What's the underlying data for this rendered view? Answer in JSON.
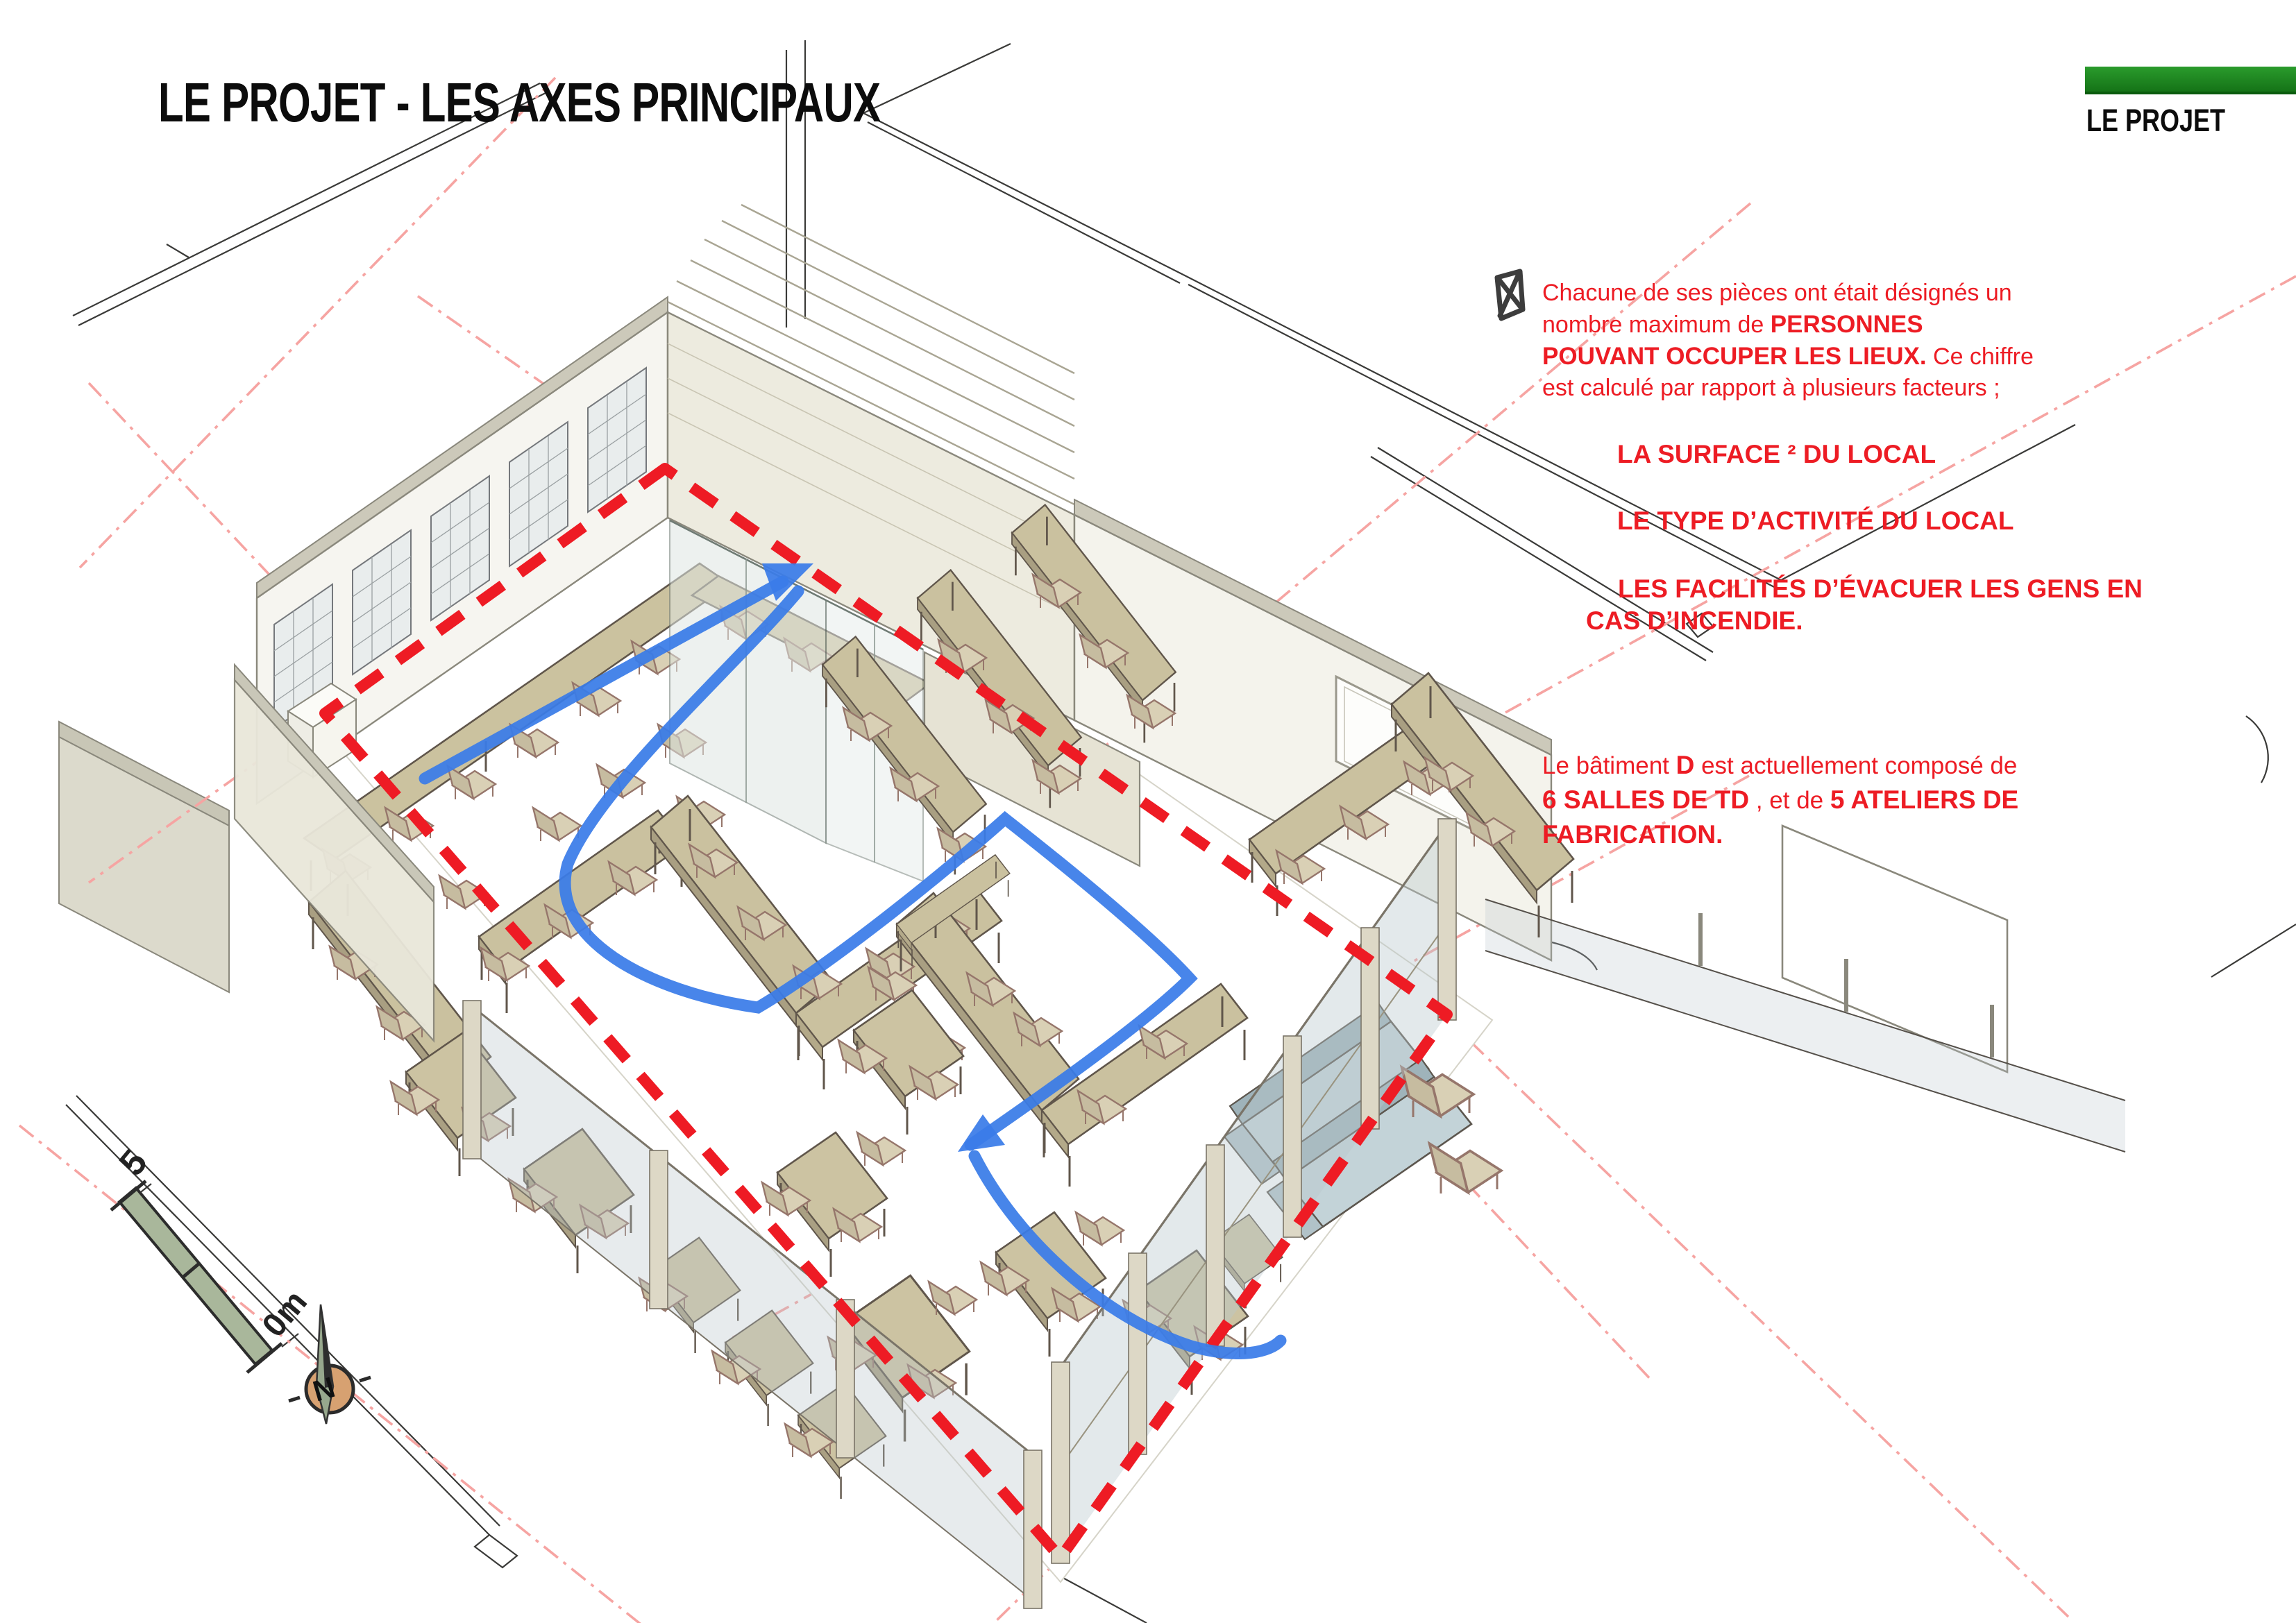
{
  "header": {
    "title": "LE PROJET - LES AXES PRINCIPAUX",
    "corner_label": "LE PROJET",
    "accent_green": "#1f8c21"
  },
  "notes": {
    "lines_p1": [
      {
        "pre": "Chacune de ses pièces ont était désignés un"
      },
      {
        "pre": "nombre maximum de ",
        "b1": "PERSONNES"
      },
      {
        "b1": "POUVANT OCCUPER LES LIEUX.",
        "mid": " Ce chiffre"
      },
      {
        "pre": "est calculé par rapport à plusieurs facteurs ;"
      }
    ],
    "factors": [
      {
        "b1": "LA SURFACE ² DU LOCAL"
      },
      {
        "b1": "LE TYPE D’ACTIVITÉ DU LOCAL"
      },
      {
        "b1": "LES FACILITÉS D’ÉVACUER LES GENS EN CAS D’INCENDIE."
      }
    ],
    "lines_p2": [
      {
        "pre": "Le bâtiment ",
        "b1": "D",
        "mid": " est actuellement composé de"
      },
      {
        "b1": "6 SALLES DE TD",
        "mid": " , et de ",
        "b2": "5 ATELIERS DE"
      },
      {
        "b1": "FABRICATION."
      }
    ],
    "text_red": "#ed1c24"
  },
  "drawing": {
    "boundary_color": "#ee1b24",
    "axis_color": "#f6a4a2",
    "flow_color": "#3a7ce8",
    "wall_color": "#efeee6",
    "furniture_color": "#cac19f",
    "glass_color": "#b9c7cc"
  },
  "legend": {
    "scale_top": "5",
    "scale_bottom": "0m",
    "north": "N"
  }
}
